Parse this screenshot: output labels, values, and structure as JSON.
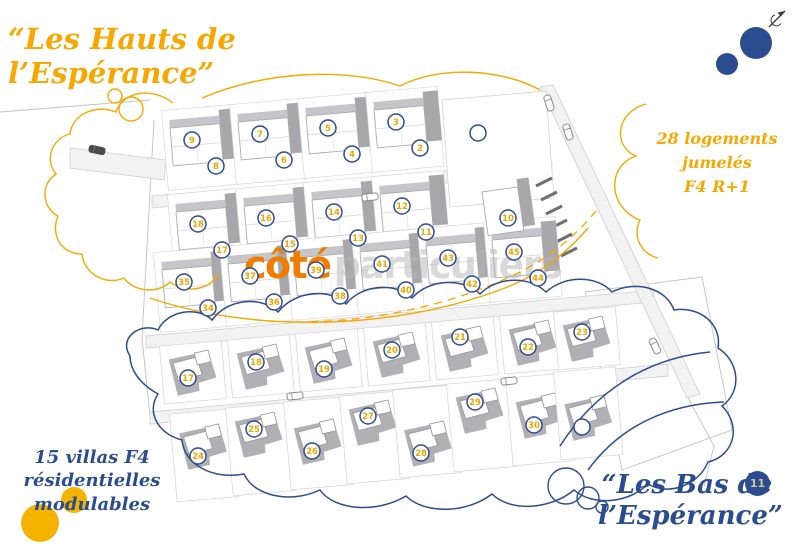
{
  "titles": {
    "top_left": {
      "line1": "“Les Hauts de",
      "line2": "l’Espérance”",
      "color": "#F5A800"
    },
    "bottom_right": {
      "line1": "“Les Bas de",
      "line2": "l’Espérance”",
      "color": "#2B4C8E"
    }
  },
  "annotations": {
    "right": {
      "line1": "28 logements jumelés",
      "line2": "F4 R+1",
      "color": "#F5A800"
    },
    "bottom_left": {
      "line1": "15 villas F4",
      "line2": "résidentielles modulables",
      "color": "#2B4C8E"
    }
  },
  "watermark": {
    "accent_text": "côté",
    "muted_text": "particuliers",
    "accent_color": "#F07C00",
    "muted_color": "#B5B5B5"
  },
  "page_number": "11",
  "icons": {
    "compass": "north-arrow",
    "cars": "car"
  },
  "colors": {
    "accent_orange": "#F5A800",
    "logo_orange": "#F07C00",
    "blue": "#2B4C8E",
    "number": "#E9A800",
    "badge_text": "#CFC49A",
    "solid_orange": "#F5B301",
    "road_fill": "#F2F2F3",
    "road_stroke": "#CFCFD3",
    "plot_stroke": "#D8D8DB",
    "shadow_dark": "#A7A7AC",
    "shadow_mid": "#C6C6CA",
    "building_stroke": "#ABABAF",
    "line": "#C2C2C6",
    "car_stroke": "#88888D",
    "car_dark": "#4A4A50",
    "hatch": "#6E6E74"
  },
  "plan": {
    "zone_hauts": {
      "label": "28 logements jumelés F4 R+1",
      "rows": [
        {
          "buildings": [
            {
              "x": 170,
              "y": 128,
              "nums": [
                "9",
                "8"
              ]
            },
            {
              "x": 238,
              "y": 122,
              "nums": [
                "7",
                "6"
              ]
            },
            {
              "x": 306,
              "y": 116,
              "nums": [
                "5",
                "4"
              ]
            },
            {
              "x": 374,
              "y": 110,
              "nums": [
                "3",
                "2"
              ]
            }
          ]
        },
        {
          "buildings": [
            {
              "x": 176,
              "y": 212,
              "nums": [
                "18",
                "17"
              ]
            },
            {
              "x": 244,
              "y": 206,
              "nums": [
                "16",
                "15"
              ]
            },
            {
              "x": 312,
              "y": 200,
              "nums": [
                "14",
                "13"
              ]
            },
            {
              "x": 380,
              "y": 194,
              "nums": [
                "12",
                "11"
              ]
            }
          ]
        },
        {
          "buildings": [
            {
              "x": 162,
              "y": 270,
              "nums": [
                "35",
                "34"
              ]
            },
            {
              "x": 228,
              "y": 264,
              "nums": [
                "37",
                "36"
              ]
            },
            {
              "x": 294,
              "y": 258,
              "nums": [
                "39",
                "38"
              ]
            },
            {
              "x": 360,
              "y": 252,
              "nums": [
                "41",
                "40"
              ]
            },
            {
              "x": 426,
              "y": 246,
              "nums": [
                "43",
                "42"
              ]
            },
            {
              "x": 492,
              "y": 240,
              "nums": [
                "45",
                "44"
              ]
            }
          ]
        }
      ],
      "corner_building": {
        "x": 482,
        "y": 192,
        "num": "10"
      },
      "open_lot": {
        "points": "442,100 546,91 554,198 450,207",
        "circle": {
          "x": 478,
          "y": 133,
          "num": ""
        }
      }
    },
    "zone_bas": {
      "label": "15 villas F4 résidentielles modulables",
      "rows": [
        {
          "plot_h": 58,
          "villas": [
            {
              "x": 162,
              "y": 352,
              "cy": 26,
              "num": "17"
            },
            {
              "x": 230,
              "y": 346,
              "cy": 16,
              "num": "18"
            },
            {
              "x": 298,
              "y": 340,
              "cy": 29,
              "num": "19"
            },
            {
              "x": 366,
              "y": 334,
              "cy": 16,
              "num": "20"
            },
            {
              "x": 434,
              "y": 328,
              "cy": 9,
              "num": "21"
            },
            {
              "x": 502,
              "y": 322,
              "cy": 25,
              "num": "22"
            },
            {
              "x": 556,
              "y": 318,
              "cy": 14,
              "num": "23"
            }
          ]
        },
        {
          "plot_h": 88,
          "villas": [
            {
              "x": 172,
              "y": 420,
              "cy": 36,
              "num": "24"
            },
            {
              "x": 228,
              "y": 414,
              "cy": 15,
              "num": "25"
            },
            {
              "x": 286,
              "y": 408,
              "cy": 43,
              "num": "26"
            },
            {
              "x": 342,
              "y": 402,
              "cy": 14,
              "num": "27"
            },
            {
              "x": 395,
              "y": 396,
              "cy": 57,
              "num": "28"
            },
            {
              "x": 449,
              "y": 390,
              "cy": 12,
              "num": "29"
            },
            {
              "x": 508,
              "y": 384,
              "cy": 41,
              "num": "30"
            },
            {
              "x": 556,
              "y": 378,
              "cy": 49,
              "num": ""
            }
          ]
        }
      ]
    },
    "cars": [
      {
        "x": 97,
        "y": 150,
        "angle": 12,
        "dark": true
      },
      {
        "x": 549,
        "y": 103,
        "angle": 72,
        "dark": false
      },
      {
        "x": 568,
        "y": 132,
        "angle": 72,
        "dark": false
      },
      {
        "x": 370,
        "y": 197,
        "angle": -6,
        "dark": false
      },
      {
        "x": 295,
        "y": 396,
        "angle": -6,
        "dark": false
      },
      {
        "x": 509,
        "y": 381,
        "angle": -6,
        "dark": false
      },
      {
        "x": 655,
        "y": 346,
        "angle": 64,
        "dark": false
      }
    ],
    "decorations": {
      "solid_circles": [
        {
          "x": 756,
          "y": 43,
          "r": 16,
          "color": "#2B4C8E"
        },
        {
          "x": 727,
          "y": 64,
          "r": 11,
          "color": "#2B4C8E"
        },
        {
          "x": 40,
          "y": 523,
          "r": 19,
          "color": "#F5B301"
        },
        {
          "x": 74,
          "y": 500,
          "r": 13,
          "color": "#F5B301"
        }
      ],
      "outline_circles_orange": [
        {
          "x": 115,
          "y": 96,
          "r": 7
        },
        {
          "x": 131,
          "y": 109,
          "r": 12
        }
      ],
      "outline_circles_blue": [
        {
          "x": 566,
          "y": 486,
          "r": 18
        },
        {
          "x": 588,
          "y": 498,
          "r": 11
        },
        {
          "x": 602,
          "y": 507,
          "r": 6
        }
      ]
    }
  }
}
